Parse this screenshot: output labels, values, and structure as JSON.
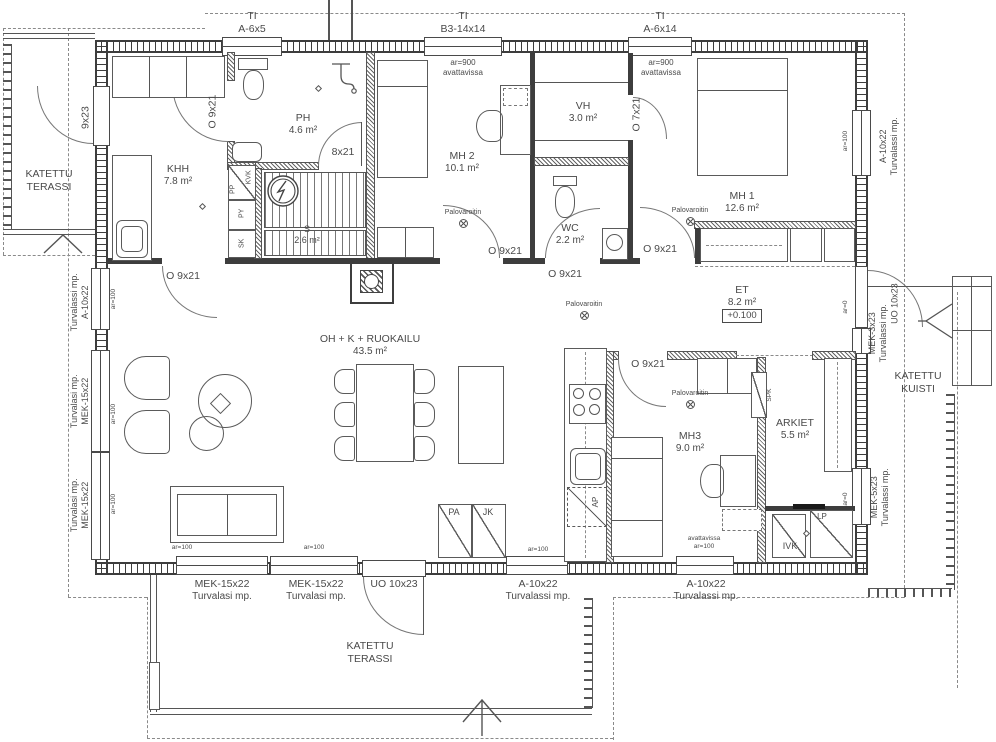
{
  "rooms": {
    "terassi_tl": {
      "l1": "KATETTU",
      "l2": "TERASSI"
    },
    "khh": {
      "name": "KHH",
      "area": "7.8 m²"
    },
    "ph": {
      "name": "PH",
      "area": "4.6 m²"
    },
    "sauna": {
      "name": "S",
      "area": "2.6 m²"
    },
    "mh2": {
      "name": "MH 2",
      "area": "10.1 m²"
    },
    "vh": {
      "name": "VH",
      "area": "3.0 m²"
    },
    "wc": {
      "name": "WC",
      "area": "2.2 m²"
    },
    "mh1": {
      "name": "MH 1",
      "area": "12.6 m²"
    },
    "et": {
      "name": "ET",
      "area": "8.2 m²",
      "level": "+0.100"
    },
    "oh": {
      "name": "OH + K + RUOKAILU",
      "area": "43.5 m²"
    },
    "mh3": {
      "name": "MH3",
      "area": "9.0 m²"
    },
    "arkiet": {
      "name": "ARKIET",
      "area": "5.5 m²"
    },
    "kuisti": {
      "l1": "KATETTU",
      "l2": "KUISTI"
    },
    "terassi_b": {
      "l1": "KATETTU",
      "l2": "TERASSI"
    }
  },
  "openings": {
    "ti1": {
      "l1": "TI",
      "l2": "A-6x5"
    },
    "ti2": {
      "l1": "TI",
      "l2": "B3-14x14"
    },
    "ti3": {
      "l1": "TI",
      "l2": "A-6x14"
    },
    "door_9x23": "9x23",
    "door_o9x21": "O 9x21",
    "door_8x21": "8x21",
    "door_o7x21": "O 7x21",
    "door_uo10x23": "UO 10x23",
    "win_a10x22": "A-10x22",
    "win_mek15x22": "MEK-15x22",
    "win_mek3x23": "MEK-3x23",
    "win_mek5x23": "MEK-5x23",
    "note_turvalasi": "Turvalasi mp.",
    "note_turvalassi": "Turvalassi mp."
  },
  "notes": {
    "ar900": "ar=900",
    "avattavissa": "avattavissa",
    "ar100": "ar=100",
    "ar0": "ar=0",
    "palovaroitin": "Palovaroitin"
  },
  "appliances": {
    "pp": "PP",
    "kvk": "KVK",
    "py": "PY",
    "sk": "SK",
    "pa": "PA",
    "jk": "JK",
    "ap": "AP",
    "spk": "SPK",
    "ivk": "IVK",
    "lp": "LP"
  },
  "colors": {
    "line": "#3d3d3d",
    "text": "#4a4a4a",
    "background": "#ffffff"
  }
}
